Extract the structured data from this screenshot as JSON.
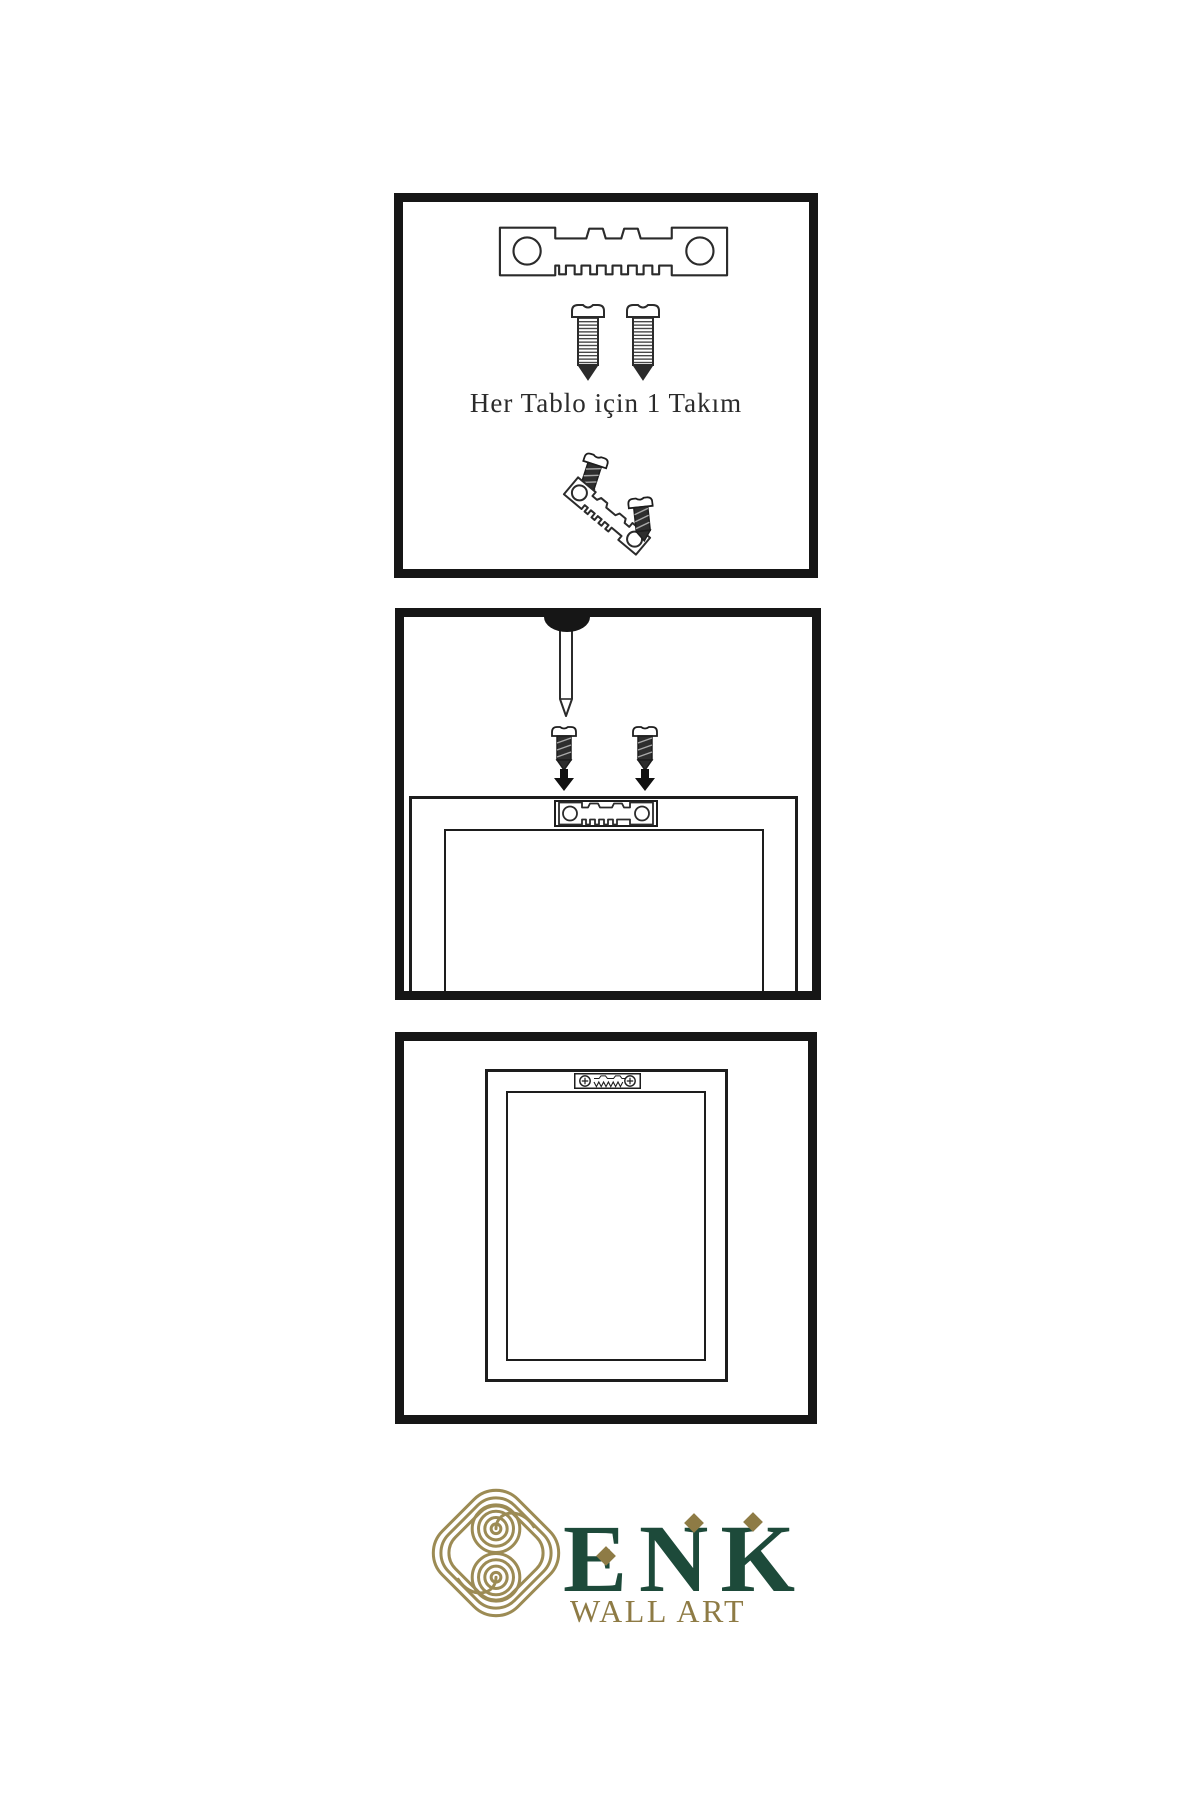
{
  "page": {
    "background_color": "#ffffff"
  },
  "step1": {
    "caption": "Her Tablo için 1 Takım",
    "icons": [
      "sawtooth-hanger-icon",
      "screw-icon",
      "screw-icon",
      "dark-screw-icon",
      "angled-sawtooth-hanger-icon",
      "dark-screw-icon"
    ]
  },
  "step2": {
    "icons": [
      "wall-nail-icon",
      "dark-screw-icon",
      "dark-screw-icon",
      "down-arrow-icon",
      "down-arrow-icon",
      "frame-back-outline",
      "sawtooth-hanger-plate-icon"
    ]
  },
  "step3": {
    "icons": [
      "frame-back-outline",
      "installed-sawtooth-hanger-icon"
    ]
  },
  "brand": {
    "name": "ENK",
    "subtitle": "WALL ART",
    "logo": "interlocking-knot-icon",
    "colors": {
      "green": "#1D4A3A",
      "gold": "#8E7B45",
      "knot_gold": "#9C8B54",
      "line": "#2B2B2B"
    }
  }
}
